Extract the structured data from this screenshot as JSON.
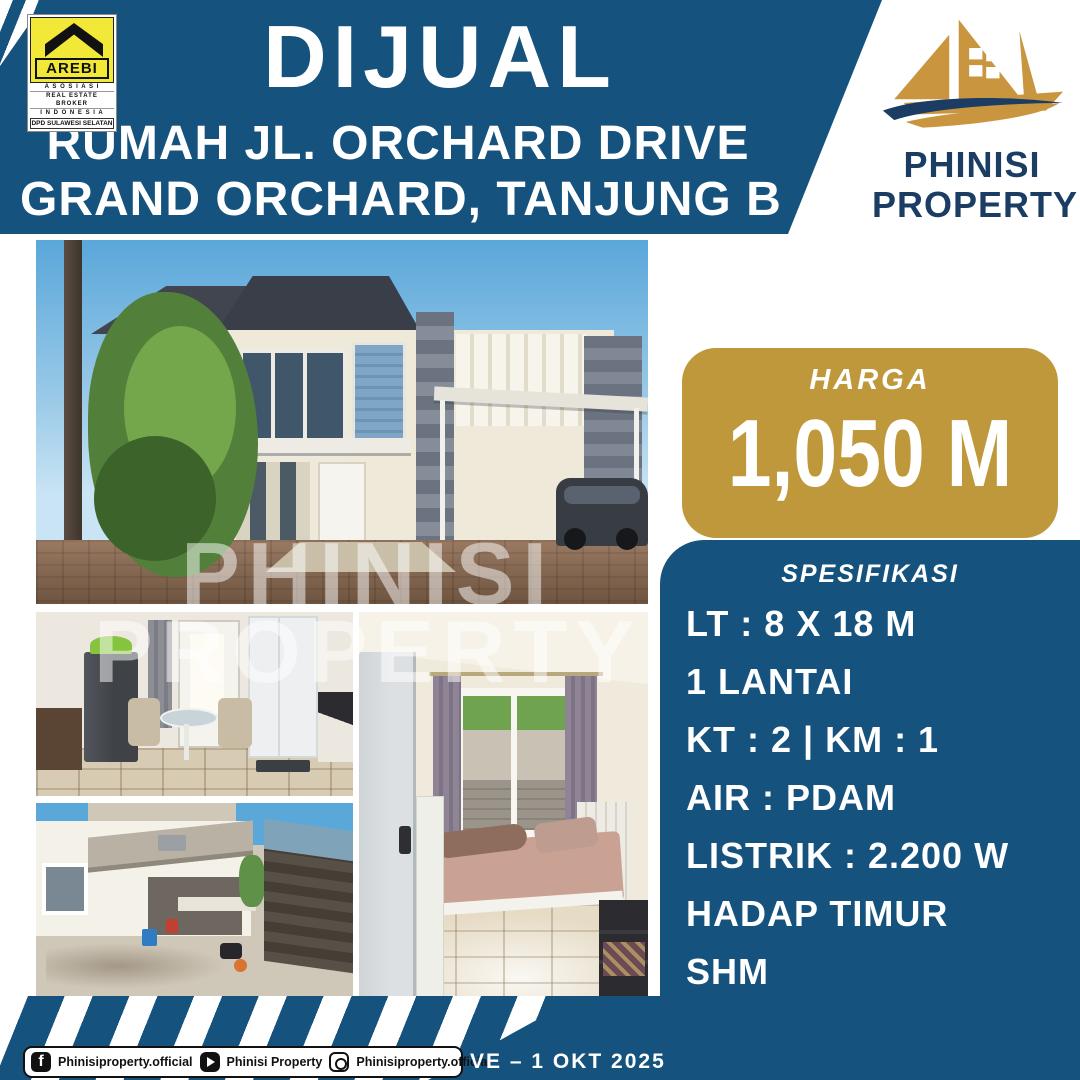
{
  "colors": {
    "primary_blue": "#15537E",
    "navy": "#1B3D63",
    "gold": "#C0983C",
    "arebi_yellow": "#F2E838"
  },
  "header": {
    "title": "DIJUAL",
    "subtitle_line1": "RUMAH JL. ORCHARD DRIVE",
    "subtitle_line2": "GRAND ORCHARD, TANJUNG B"
  },
  "arebi_logo": {
    "word": "AREBI",
    "line1": "A S O S I A S I",
    "line2": "REAL ESTATE BROKER",
    "line3": "I N D O N E S I A",
    "line4": "DPD SULAWESI SELATAN"
  },
  "phinisi_logo": {
    "line1": "PHINISI",
    "line2": "PROPERTY"
  },
  "price": {
    "label": "HARGA",
    "value": "1,050 M"
  },
  "specs": {
    "heading": "SPESIFIKASI",
    "items": [
      "LT : 8 X 18 M",
      "1 LANTAI",
      "KT : 2  |  KM : 1",
      "AIR : PDAM",
      "LISTRIK : 2.200 W",
      "HADAP TIMUR",
      "SHM"
    ]
  },
  "watermark": {
    "line1": "PHINISI",
    "line2": "PROPERTY"
  },
  "footer": {
    "social": [
      {
        "icon": "facebook-icon",
        "handle": "Phinisiproperty.official"
      },
      {
        "icon": "youtube-icon",
        "handle": "Phinisi Property"
      },
      {
        "icon": "instagram-icon",
        "handle": "Phinisiproperty.official"
      }
    ],
    "date_code": "VE – 1 OKT 2025"
  }
}
